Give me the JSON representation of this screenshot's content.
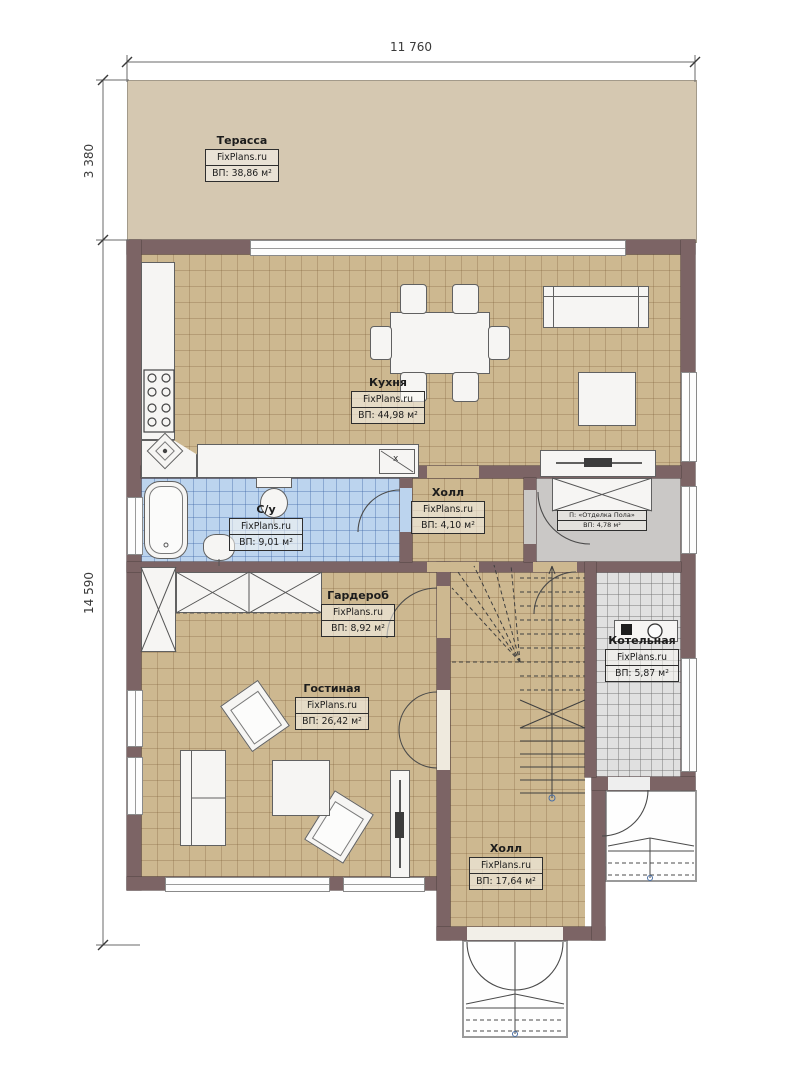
{
  "dimensions": {
    "top_width": "11 760",
    "terrace_height": "3 380",
    "house_height": "14 590"
  },
  "colors": {
    "wall": "#7c6465",
    "floor_tile_tan": "#cdb890",
    "floor_tile_blue": "#bcd4ee",
    "floor_vestibule_gray": "#cac8c6",
    "floor_boiler_gray": "#e0e0e0",
    "terrace_fill": "#d5c8b1"
  },
  "rooms": {
    "terrace": {
      "name": "Терасса",
      "brand": "FixPlans.ru",
      "area": "ВП: 38,86 м²"
    },
    "kitchen": {
      "name": "Кухня",
      "brand": "FixPlans.ru",
      "area": "ВП: 44,98 м²",
      "sink_mark": "x"
    },
    "bathroom": {
      "name": "С/у",
      "brand": "FixPlans.ru",
      "area": "ВП: 9,01 м²"
    },
    "hall_small": {
      "name": "Холл",
      "brand": "FixPlans.ru",
      "area": "ВП: 4,10 м²"
    },
    "vestibule": {
      "line1": "П: «Отделка Пола»",
      "line2": "ВП: 4,78 м²"
    },
    "wardrobe": {
      "name": "Гардероб",
      "brand": "FixPlans.ru",
      "area": "ВП: 8,92 м²"
    },
    "boiler": {
      "name": "Котельная",
      "brand": "FixPlans.ru",
      "area": "ВП: 5,87 м²"
    },
    "living": {
      "name": "Гостиная",
      "brand": "FixPlans.ru",
      "area": "ВП: 26,42 м²"
    },
    "hall_main": {
      "name": "Холл",
      "brand": "FixPlans.ru",
      "area": "ВП: 17,64 м²"
    }
  }
}
